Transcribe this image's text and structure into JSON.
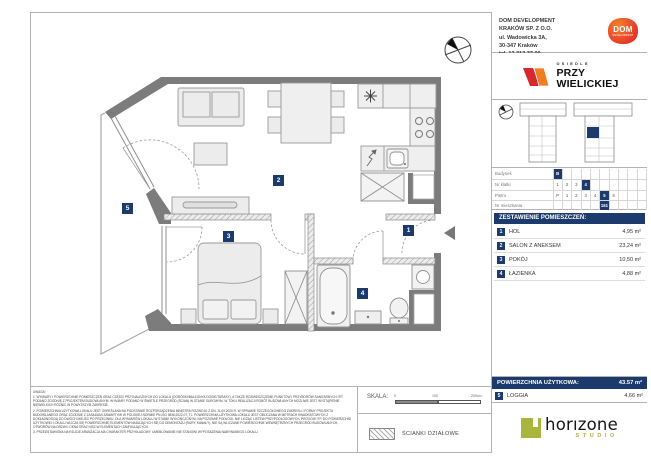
{
  "developer": {
    "lines": [
      "DOM DEVELOPMENT",
      "KRAKÓW SP. Z O.O.",
      "ul. Wadowicka 3A,",
      "30-347 Kraków",
      "tel. 12 312 37 00"
    ],
    "logo_text": "DOM",
    "logo_subtext": "DEVELOPMENT"
  },
  "estate": {
    "word_top": "OSIEDLE",
    "name_line1": "PRZY",
    "name_line2": "WIELICKIEJ"
  },
  "location_table": {
    "rows": [
      {
        "label": "Budynek",
        "cells": [
          "B",
          "",
          "",
          "",
          "",
          "",
          "",
          "",
          "",
          ""
        ]
      },
      {
        "label": "Nr klatki",
        "cells": [
          "1",
          "2",
          "3",
          "4",
          "",
          "",
          "",
          "",
          "",
          ""
        ]
      },
      {
        "label": "Piętro",
        "cells": [
          "P",
          "1",
          "2",
          "3",
          "4",
          "5",
          "6",
          "",
          "",
          ""
        ]
      },
      {
        "label": "Nr mieszkania",
        "cells": [
          "",
          "",
          "",
          "",
          "",
          "151",
          "",
          "",
          "",
          ""
        ]
      }
    ]
  },
  "room_list": {
    "header": "ZESTAWIENIE POMIESZCZEŃ:",
    "rooms": [
      {
        "number": "1",
        "name": "HOL",
        "area": "4,95 m²"
      },
      {
        "number": "2",
        "name": "SALON Z ANEKSEM",
        "area": "23,24 m²"
      },
      {
        "number": "3",
        "name": "POKÓJ",
        "area": "10,50 m²"
      },
      {
        "number": "4",
        "name": "ŁAZIENKA",
        "area": "4,88 m²"
      }
    ],
    "total_label": "POWIERZCHNIA UŻYTKOWA:",
    "total_value": "43.57 m²",
    "extra": {
      "number": "5",
      "name": "LOGGIA",
      "area": "4,66 m²"
    }
  },
  "plan": {
    "badges": [
      "1",
      "2",
      "3",
      "4",
      "5"
    ]
  },
  "footer": {
    "uwaga": "UWAGA:",
    "notes": [
      "1. WYMIARY I POWIERZCHNIE POMIESZCZEŃ ORAZ CZĘŚCI PRZYNALEŻNYCH DO LOKALU (OGRÓDKI/BALKONY/LOGGIE/TARASY), A TAKŻE ROZMIESZCZENIE PUNKTÓW I PRZYBORÓW SANITARNYCH ITP. PODANO ZGODNIE Z PROJEKTEM BUDOWLANYM. WYMIARY PODANO W ŚWIETLE PRZEGRÓD (ŚCIAN) W STANIE SUROWYM. W TOKU REALIZACJI ROBÓT BUDOWLANYCH MOŻLIWE JEST WYSTĄPIENIE NIEWIELKICH RÓŻNIC W POWYŻSZYM ZAKRESIE.",
      "2. POWIERZCHNIA UŻYTKOWA LOKALU JEST OKREŚLANA NA PODSTAWIE ROZPORZĄDZENIA MINISTRA ROZWOJU Z DN. 11.09.2020 R. W SPRAWIE SZCZEGÓŁOWEGO ZAKRESU I FORMY PROJEKTU BUDOWLANEGO ORAZ ZGODNIE Z ZASADAMI ZAWARTYMI W POLSKIEJ NORMIE PN-ISO 9836:2022-07, TJ. POWIERZCHNIA UŻYTKOWA LOKALU JEST OBLICZANA W METRACH KWADRATOWYCH Z DOKŁADNOŚCIĄ DO DWÓCH MIEJSC PO PRZECINKU, DLA WYMIARÓW LOKALU W STANIE WYKOŃCZONYM, NA POZIOMIE PODŁOGI, NIE LICZĄC LISTEW PRZYPODŁOGOWYCH, PROGÓW ITP. DO POWIERZCHNI UŻYTKOWEJ LOKALU WLICZA SIĘ POWIERZCHNIĘ ELEMENTÓW NADAJĄCYCH SIĘ DO DEMONTAŻU (RURY, KANAŁY). NIE SĄ WLICZANE POWIERZCHNIE WEWNĘTRZNYCH PRZEGRÓD BUDOWLANYCH, OTWORÓW NA DRZWI I OKNA ORAZ NISZ W ELEMENTACH ZAMYKAJĄCYCH.",
      "3. PRZEDSTAWIONA NA RZUCIE ARANŻACJA MA CHARAKTER PRZYKŁADOWY. UMEBLOWANIE NIE STANOWI WYPOSAŻENIA NABYWANEGO LOKALU."
    ],
    "scale_label": "SKALA:",
    "scale_ticks": [
      "0",
      "100",
      "200cm"
    ],
    "legend_partition": "ŚCIANKI DZIAŁOWE"
  },
  "studio": {
    "name": "horızone",
    "sub": "STUDIO"
  },
  "colors": {
    "navy": "#1c3a6b",
    "wall_gray": "#7c7c7c",
    "dom_red": "#e02b26",
    "brand_orange": "#f5822b",
    "horizone_green": "#a9b53c"
  }
}
